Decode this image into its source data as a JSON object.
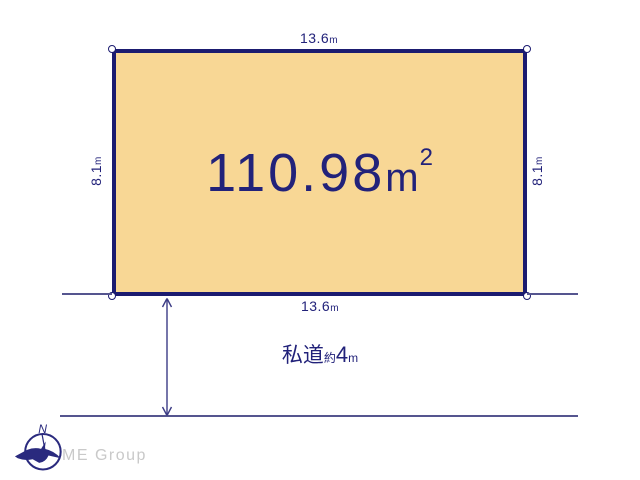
{
  "plot": {
    "area_value": "110.98",
    "area_unit": "m",
    "area_sup": "2",
    "fill_color": "#f8d795",
    "border_color": "#1b1b70"
  },
  "dimensions": {
    "top": {
      "value": "13.6",
      "unit": "m"
    },
    "bottom": {
      "value": "13.6",
      "unit": "m"
    },
    "left": {
      "value": "8.1",
      "unit": "m"
    },
    "right": {
      "value": "8.1",
      "unit": "m"
    }
  },
  "road": {
    "name": "私道",
    "approx": "約",
    "width_value": "4",
    "width_unit": "m"
  },
  "branding": {
    "company": "ME Group",
    "compass_letter": "N"
  },
  "colors": {
    "text_navy": "#22227a",
    "thin_line": "#55558f",
    "brand_gray": "#c9c9c9",
    "background": "#ffffff"
  }
}
